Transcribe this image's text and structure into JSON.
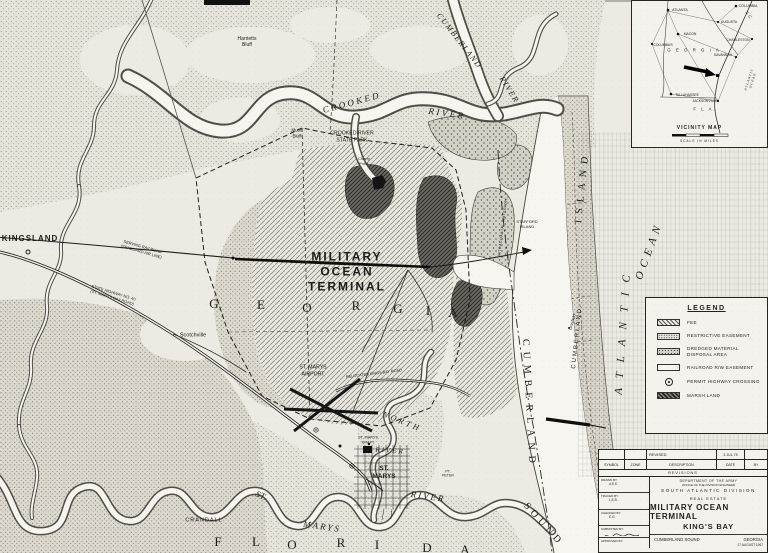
{
  "colors": {
    "paper": "#edeae3",
    "ink": "#1f1f1f",
    "water": "#f7f5ef"
  },
  "map": {
    "labels": [
      {
        "id": "kingsland",
        "text": "KINGSLAND",
        "x": 30,
        "y": 239,
        "size": 8,
        "weight": 700,
        "spacing": 1
      },
      {
        "id": "harrietts-bluff",
        "text": "Harrietts\nBluff",
        "x": 247,
        "y": 42,
        "size": 5
      },
      {
        "id": "mush-bluff",
        "text": "Mush\nBluff",
        "x": 297,
        "y": 133,
        "size": 4.6
      },
      {
        "id": "crooked-river-word1",
        "text": "CROOKED",
        "x": 352,
        "y": 103,
        "size": 9,
        "rot": -15,
        "spacing": 2.5,
        "italic": true,
        "serif": true
      },
      {
        "id": "crooked-river-word2",
        "text": "RIVER",
        "x": 447,
        "y": 114,
        "size": 9,
        "rot": 8,
        "spacing": 2.5,
        "italic": true,
        "serif": true
      },
      {
        "id": "crooked-river-state-park",
        "text": "CROOKED RIVER\nSTATE PARK",
        "x": 352,
        "y": 137,
        "size": 5.2
      },
      {
        "id": "cherry-point",
        "text": "Cherry\nPoint",
        "x": 364,
        "y": 161,
        "size": 4
      },
      {
        "id": "cumberland-river-word1",
        "text": "CUMBERLAND",
        "x": 459,
        "y": 41,
        "size": 8,
        "rot": 52,
        "spacing": 1.5,
        "italic": true,
        "serif": true
      },
      {
        "id": "cumberland-river-word2",
        "text": "RIVER",
        "x": 509,
        "y": 90,
        "size": 8,
        "rot": 58,
        "spacing": 1.5,
        "italic": true,
        "serif": true
      },
      {
        "id": "military-ocean-terminal",
        "text": "MILITARY\nOCEAN\nTERMINAL",
        "x": 347,
        "y": 272,
        "size": 12,
        "weight": 700,
        "spacing": 2
      },
      {
        "id": "georgia-letter-g1",
        "text": "G",
        "x": 214,
        "y": 304,
        "size": 13,
        "serif": true
      },
      {
        "id": "georgia-letter-e",
        "text": "E",
        "x": 261,
        "y": 305,
        "size": 13,
        "serif": true
      },
      {
        "id": "georgia-letter-o",
        "text": "O",
        "x": 307,
        "y": 308,
        "size": 13,
        "serif": true
      },
      {
        "id": "georgia-letter-r",
        "text": "R",
        "x": 356,
        "y": 306,
        "size": 13,
        "serif": true
      },
      {
        "id": "georgia-letter-g2",
        "text": "G",
        "x": 398,
        "y": 309,
        "size": 13,
        "serif": true
      },
      {
        "id": "georgia-letter-i",
        "text": "I",
        "x": 428,
        "y": 311,
        "size": 13,
        "serif": true
      },
      {
        "id": "georgia-letter-a",
        "text": "A",
        "x": 453,
        "y": 313,
        "size": 13,
        "serif": true
      },
      {
        "id": "scotchville",
        "text": "Scotchville",
        "x": 193,
        "y": 336,
        "size": 5.5
      },
      {
        "id": "serving-railroad",
        "text": "SERVING RAILROAD\n(SEABOARD AIR LINE)",
        "x": 142,
        "y": 249,
        "size": 4,
        "rot": 16
      },
      {
        "id": "state-highway-40",
        "text": "STATE HIGHWAY NO. 40\n(ST. MARYS RAILROAD)",
        "x": 113,
        "y": 295,
        "size": 4,
        "rot": 17
      },
      {
        "id": "st-marys-airport",
        "text": "ST. MARYS\nAIRPORT",
        "x": 313,
        "y": 371,
        "size": 5.2
      },
      {
        "id": "relocated-road",
        "text": "RELOCATED KINGS BAY ROAD",
        "x": 374,
        "y": 374,
        "size": 3.8,
        "rot": -7
      },
      {
        "id": "north-river-word1",
        "text": "NORTH",
        "x": 402,
        "y": 422,
        "size": 8,
        "rot": 22,
        "spacing": 3,
        "italic": true,
        "serif": true
      },
      {
        "id": "north-river-word2",
        "text": "RIVER",
        "x": 390,
        "y": 451,
        "size": 7,
        "rot": 4,
        "spacing": 2,
        "italic": true,
        "serif": true
      },
      {
        "id": "st-marys-kraft",
        "text": "ST. MARYS\nKRAFT",
        "x": 368,
        "y": 440,
        "size": 3.8
      },
      {
        "id": "st-marys-town",
        "text": "ST.\nMARYS",
        "x": 384,
        "y": 473,
        "size": 6.5,
        "weight": 700
      },
      {
        "id": "st-marys-river-word1",
        "text": "ST.",
        "x": 261,
        "y": 496,
        "size": 9,
        "rot": 22,
        "italic": true,
        "serif": true
      },
      {
        "id": "st-marys-river-word2",
        "text": "MARYS",
        "x": 322,
        "y": 527,
        "size": 9,
        "rot": 8,
        "spacing": 2,
        "italic": true,
        "serif": true
      },
      {
        "id": "st-marys-river-word3",
        "text": "RIVER",
        "x": 428,
        "y": 497,
        "size": 9,
        "rot": 8,
        "spacing": 2,
        "italic": true,
        "serif": true
      },
      {
        "id": "crandall",
        "text": "CRANDALL",
        "x": 204,
        "y": 521,
        "size": 5.5,
        "spacing": 1
      },
      {
        "id": "florida-letter-f",
        "text": "F",
        "x": 218,
        "y": 542,
        "size": 13,
        "serif": true
      },
      {
        "id": "florida-letter-l",
        "text": "L",
        "x": 256,
        "y": 542,
        "size": 13,
        "serif": true
      },
      {
        "id": "florida-letter-o",
        "text": "O",
        "x": 292,
        "y": 545,
        "size": 13,
        "serif": true
      },
      {
        "id": "florida-letter-r",
        "text": "R",
        "x": 341,
        "y": 543,
        "size": 13,
        "serif": true
      },
      {
        "id": "florida-letter-i",
        "text": "I",
        "x": 377,
        "y": 545,
        "size": 13,
        "serif": true
      },
      {
        "id": "florida-letter-d",
        "text": "D",
        "x": 427,
        "y": 548,
        "size": 13,
        "serif": true
      },
      {
        "id": "florida-letter-a",
        "text": "A",
        "x": 465,
        "y": 550,
        "size": 13,
        "serif": true
      },
      {
        "id": "intracoastal-waterway",
        "text": "INTRACOASTAL WATERWAY",
        "x": 503,
        "y": 227,
        "size": 3.6,
        "rot": -83,
        "spacing": 0.5
      },
      {
        "id": "stafford-island",
        "text": "STAFFORD\nISLAND",
        "x": 527,
        "y": 224,
        "size": 4
      },
      {
        "id": "grayfield",
        "text": "Grayfield",
        "x": 572,
        "y": 322,
        "size": 4,
        "rot": -75
      },
      {
        "id": "point-peter",
        "text": "PT.\nPETER",
        "x": 448,
        "y": 474,
        "size": 3.6
      },
      {
        "id": "cumberland-island-word2",
        "text": "ISLAND",
        "x": 583,
        "y": 187,
        "size": 10,
        "rot": -84,
        "spacing": 6,
        "serif": true
      },
      {
        "id": "cumberland-island-word1",
        "text": "CUMBERLAND",
        "x": 578,
        "y": 338,
        "size": 6,
        "rot": -84,
        "spacing": 2
      },
      {
        "id": "cumberland-sound-word1",
        "text": "CUMBERLAND",
        "x": 528,
        "y": 404,
        "size": 10,
        "rot": 87,
        "spacing": 6,
        "serif": true
      },
      {
        "id": "cumberland-sound-word2",
        "text": "SOUND",
        "x": 543,
        "y": 525,
        "size": 10,
        "rot": 48,
        "spacing": 4,
        "serif": true
      },
      {
        "id": "atlantic-ocean-word1",
        "text": "ATLANTIC",
        "x": 624,
        "y": 330,
        "size": 11,
        "rot": -86,
        "spacing": 10,
        "italic": true,
        "serif": true
      },
      {
        "id": "atlantic-ocean-word2",
        "text": "OCEAN",
        "x": 650,
        "y": 251,
        "size": 11,
        "rot": -70,
        "spacing": 5,
        "italic": true,
        "serif": true
      }
    ]
  },
  "vicinity": {
    "title": "VICINITY MAP",
    "scale_label": "SCALE IN MILES",
    "labels": [
      {
        "id": "atlanta",
        "text": "ATLANTA",
        "x": 48,
        "y": 9,
        "size": 3.6
      },
      {
        "id": "columbia",
        "text": "COLUMBIA",
        "x": 116,
        "y": 5,
        "size": 3.6
      },
      {
        "id": "augusta",
        "text": "AUGUSTA",
        "x": 97,
        "y": 21,
        "size": 3.4
      },
      {
        "id": "macon",
        "text": "MACON",
        "x": 58,
        "y": 33,
        "size": 3.4
      },
      {
        "id": "columbus",
        "text": "COLUMBUS",
        "x": 31,
        "y": 44,
        "size": 3.4
      },
      {
        "id": "charleston",
        "text": "CHARLESTON",
        "x": 106,
        "y": 39,
        "size": 3.4
      },
      {
        "id": "savannah",
        "text": "SAVANNAH",
        "x": 91,
        "y": 54,
        "size": 3.4
      },
      {
        "id": "tallahassee",
        "text": "TALLAHASSEE",
        "x": 55,
        "y": 94,
        "size": 3.4
      },
      {
        "id": "jacksonville",
        "text": "JACKSONVILLE",
        "x": 73,
        "y": 100,
        "size": 3.4
      },
      {
        "id": "georgia-state",
        "text": "G E O R G I A",
        "x": 62,
        "y": 49,
        "size": 4.4,
        "spacing": 2
      },
      {
        "id": "south-carolina",
        "text": "S. C.",
        "x": 117,
        "y": 14,
        "size": 4,
        "rot": 55
      },
      {
        "id": "florida-state",
        "text": "F L A.",
        "x": 73,
        "y": 108,
        "size": 4.4,
        "spacing": 2
      },
      {
        "id": "atlantic-ocean-inset",
        "text": "ATLANTIC OCEAN",
        "x": 119,
        "y": 79,
        "size": 3.4,
        "rot": -72,
        "spacing": 1,
        "italic": true,
        "serif": true
      }
    ]
  },
  "legend": {
    "title": "LEGEND",
    "items": [
      {
        "key": "fee",
        "label": "FEE"
      },
      {
        "key": "restrictive",
        "label": "RESTRICTIVE EASEMENT"
      },
      {
        "key": "dredged",
        "label": "DREDGED MATERIAL\nDISPOSAL AREA"
      },
      {
        "key": "railroad",
        "label": "RAILROAD R/W EASEMENT"
      },
      {
        "key": "permit",
        "label": "PERMIT HIGHWAY CROSSING"
      },
      {
        "key": "marsh",
        "label": "MARSH LAND"
      }
    ]
  },
  "title_block": {
    "revised_label": "REVISED",
    "revised_date": "3 JUL 75",
    "col_symbol": "SYMBOL",
    "col_zone": "ZONE",
    "col_description": "DESCRIPTION",
    "col_date": "DATE",
    "col_by": "BY",
    "revisions_label": "REVISIONS",
    "dept_line1": "DEPARTMENT OF THE ARMY",
    "dept_line2": "OFFICE OF THE DIVISION ENGINEER",
    "dept_line3": "SOUTH ATLANTIC DIVISION",
    "real_estate": "REAL ESTATE",
    "title_line1": "MILITARY OCEAN TERMINAL",
    "title_line2": "KING'S BAY",
    "location_left": "CUMBERLAND SOUND",
    "location_right": "GEORGIA",
    "date_note": "17 AUGUST 1967",
    "sign_rows": [
      {
        "label": "DRAWN BY:",
        "value": "A.E.E."
      },
      {
        "label": "TRACED BY:",
        "value": "L.E.B."
      },
      {
        "label": "CHECKED BY:",
        "value": "E.G."
      },
      {
        "label": "SUBMITTED BY:",
        "value": ""
      },
      {
        "label": "APPROVED BY:",
        "value": ""
      }
    ]
  }
}
